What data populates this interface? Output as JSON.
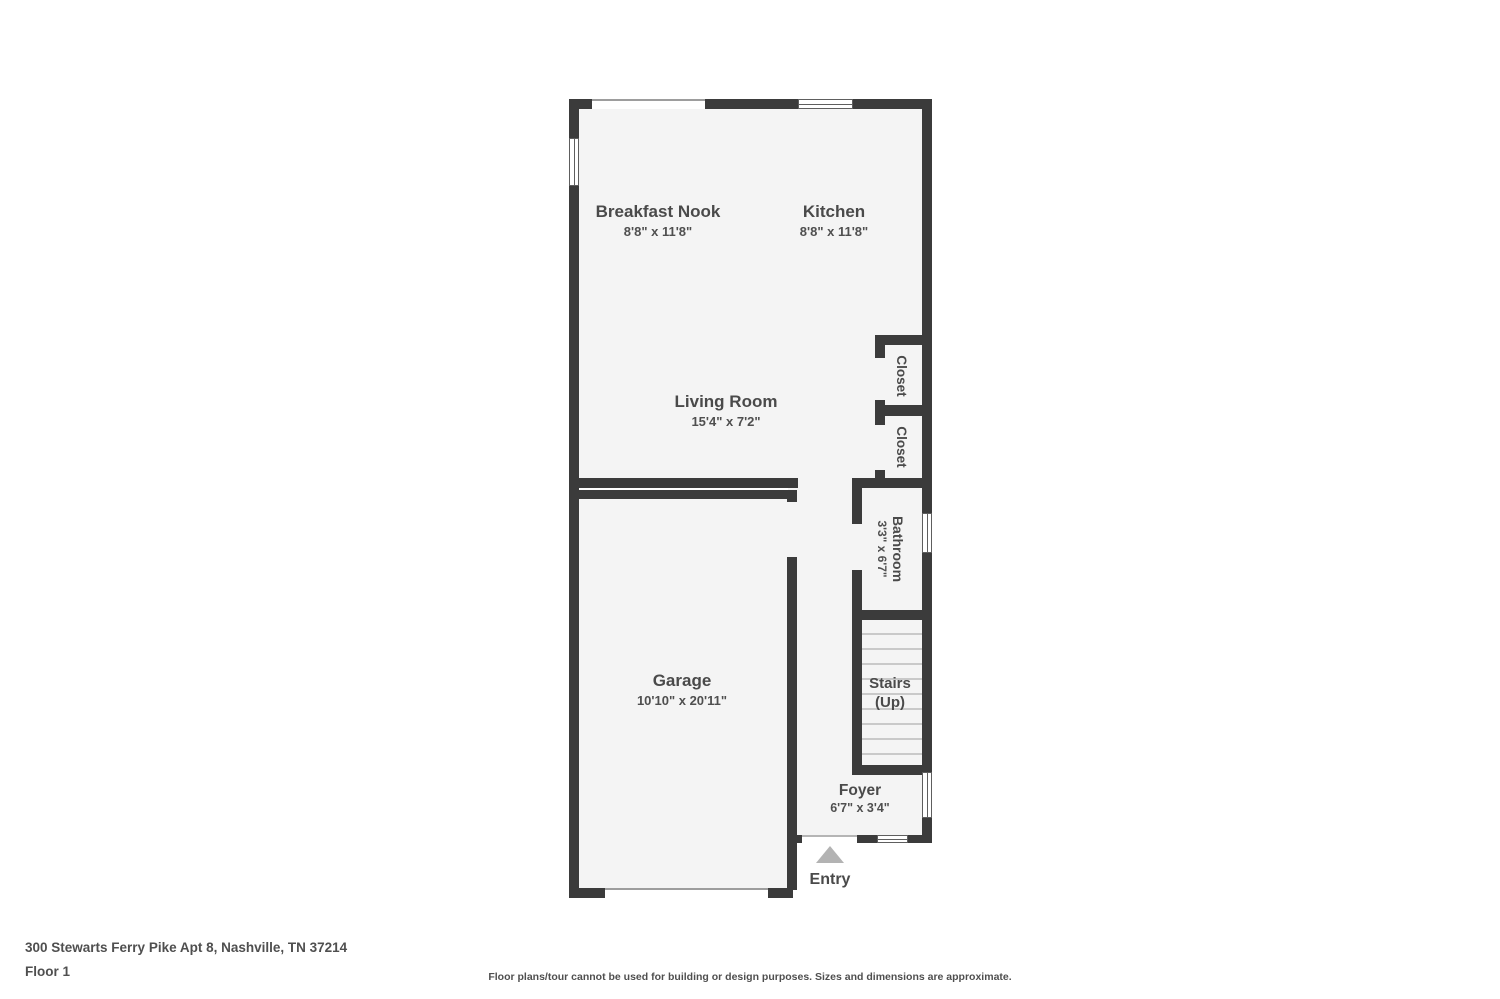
{
  "floorplan": {
    "rooms": {
      "breakfast_nook": {
        "name": "Breakfast Nook",
        "dims": "8'8\" x 11'8\""
      },
      "kitchen": {
        "name": "Kitchen",
        "dims": "8'8\" x 11'8\""
      },
      "living_room": {
        "name": "Living Room",
        "dims": "15'4\" x 7'2\""
      },
      "garage": {
        "name": "Garage",
        "dims": "10'10\" x 20'11\""
      },
      "closet_upper": {
        "name": "Closet"
      },
      "closet_lower": {
        "name": "Closet"
      },
      "bathroom": {
        "name": "Bathroom",
        "dims": "3'3\" x 6'7\""
      },
      "stairs": {
        "name": "Stairs",
        "direction": "(Up)"
      },
      "foyer": {
        "name": "Foyer",
        "dims": "6'7\" x 3'4\""
      }
    },
    "entry_label": "Entry",
    "colors": {
      "wall": "#3b3b3b",
      "floor_fill": "#f4f4f4",
      "label_text": "#4a4a4a",
      "entry_arrow": "#b3b3b3",
      "stair_tread_line": "#c9c9c9"
    }
  },
  "footer": {
    "address": "300 Stewarts Ferry Pike Apt 8, Nashville, TN 37214",
    "floor_label": "Floor 1",
    "disclaimer": "Floor plans/tour cannot be used for building or design purposes. Sizes and dimensions are approximate."
  }
}
